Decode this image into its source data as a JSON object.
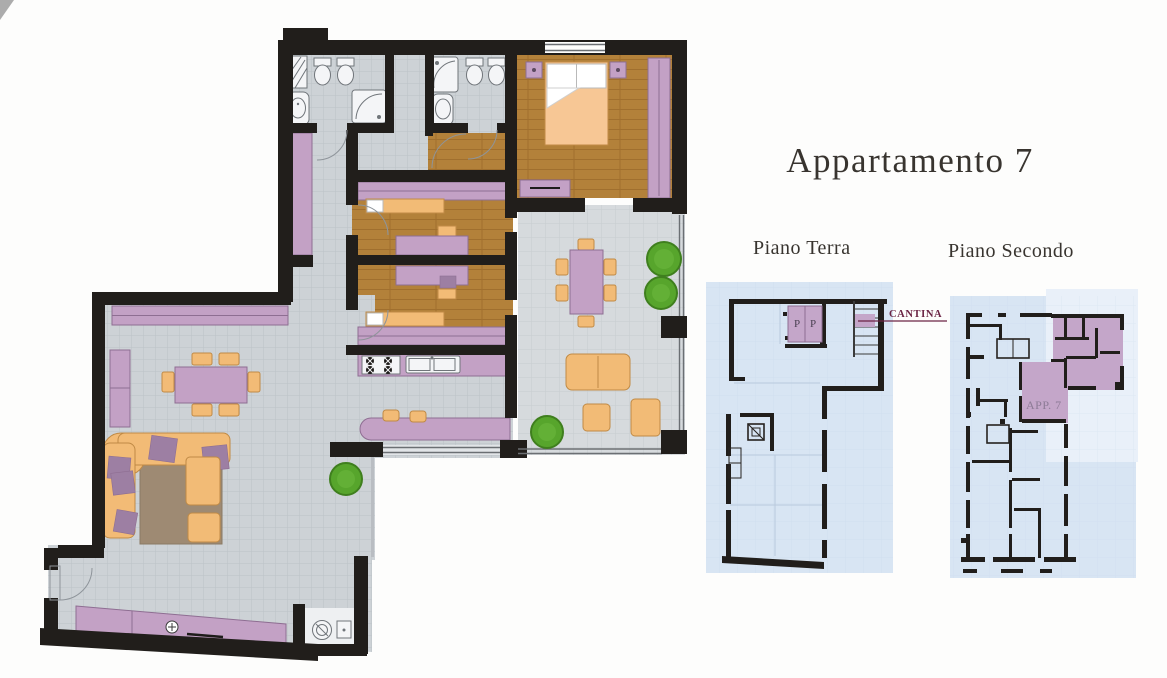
{
  "page": {
    "title": "Appartamento 7"
  },
  "plans": {
    "main": {
      "name": "apartment-7-floor-plan"
    },
    "piano_terra": {
      "label": "Piano Terra",
      "cantina_label": "CANTINA",
      "parking_left": "P",
      "parking_right": "P"
    },
    "piano_secondo": {
      "label": "Piano Secondo",
      "apartment_label": "APP. 7"
    }
  },
  "colors": {
    "wall": "#211e1b",
    "tile_floor": "#cdd2d6",
    "tile_line": "#bcc2c7",
    "terrace_tile": "#d6dadd",
    "terrace_line": "#c7ccd0",
    "wood_floor": "#b3813a",
    "wood_line": "#a06f2e",
    "furniture_purple": "#c3a1c5",
    "furniture_purple_dark": "#8e6e92",
    "cushion_purple": "#9d7fa3",
    "furniture_tan": "#f2bb76",
    "furniture_tan_dark": "#c08a45",
    "bed_peach": "#f7c795",
    "rug_brown": "#9e8a73",
    "plant_green": "#57a52c",
    "plant_green_dark": "#3f7f1e",
    "fixture_white": "#f4f5f7",
    "fixture_line": "#70757a",
    "plan_blue": "#d8e5f3",
    "plan_blue_light": "#e9f0f9",
    "highlight_purple": "#c4a6c9",
    "cantina_text": "#6b2444",
    "app7_text": "#8d7b96",
    "parking_text": "#4a4152",
    "title_text": "#38342f"
  }
}
